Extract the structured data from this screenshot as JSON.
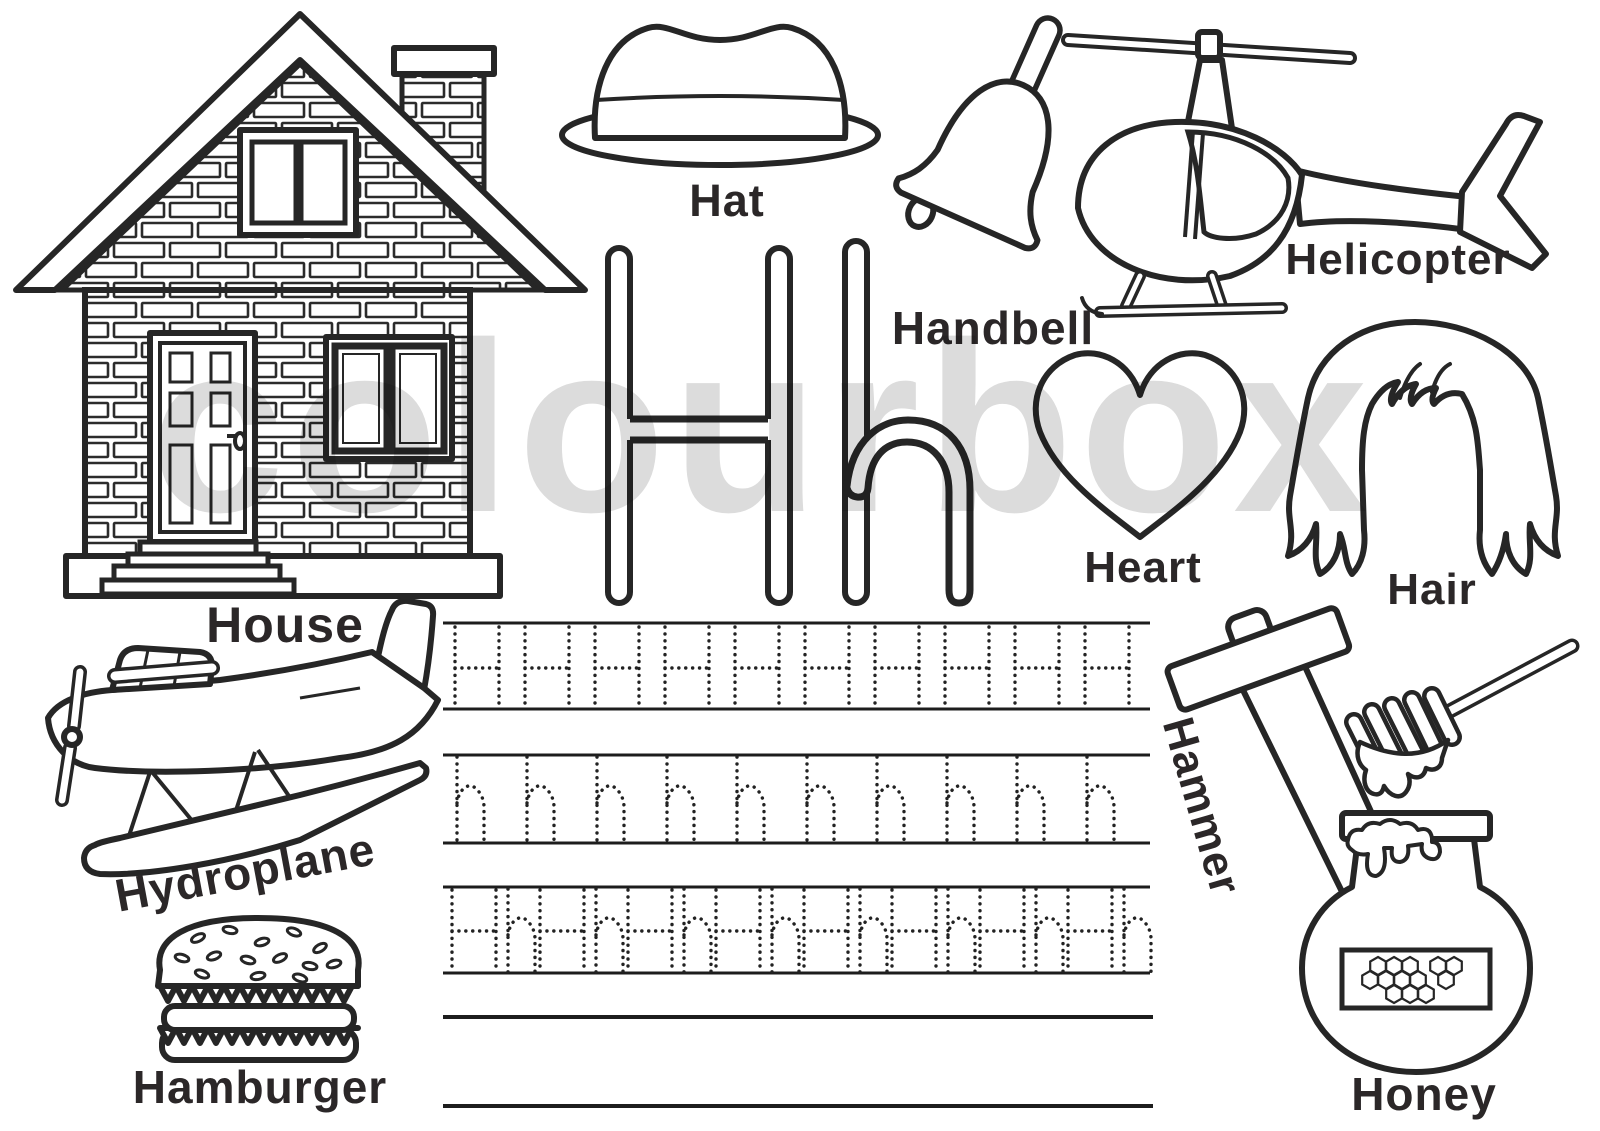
{
  "page": {
    "type": "alphabet-tracing-worksheet",
    "letter": "H",
    "background": "#ffffff",
    "ink_color": "#262626",
    "label_color": "#2b2728",
    "watermark": {
      "text": "colourbox",
      "color": "#dcdcdc"
    }
  },
  "letters": {
    "uppercase": "H",
    "lowercase": "h"
  },
  "labels": {
    "house": "House",
    "hat": "Hat",
    "handbell": "Handbell",
    "helicopter": "Helicopter",
    "heart": "Heart",
    "hair": "Hair",
    "hydroplane": "Hydroplane",
    "hamburger": "Hamburger",
    "hammer": "Hammer",
    "honey": "Honey"
  },
  "illustrations": [
    "house-icon",
    "hat-icon",
    "handbell-icon",
    "helicopter-icon",
    "big-letters-Hh",
    "heart-icon",
    "hair-icon",
    "hydroplane-icon",
    "hamburger-icon",
    "hammer-icon",
    "honey-dipper-icon",
    "honey-jar-icon"
  ],
  "tracing": {
    "rows": [
      {
        "pattern": "H",
        "count": 10,
        "style": "dotted"
      },
      {
        "pattern": "h",
        "count": 10,
        "style": "dotted"
      },
      {
        "pattern": "Hh",
        "count": 8,
        "style": "dotted"
      }
    ],
    "blank_lines": 2
  }
}
